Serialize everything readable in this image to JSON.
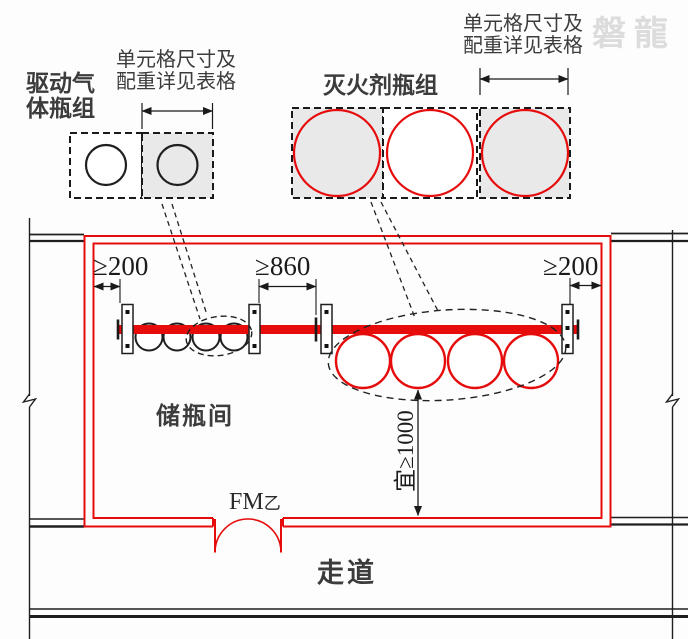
{
  "watermark": "磐龍",
  "colors": {
    "accent_red": "#e60c0c",
    "cell_fill_gray": "#e9e9e9",
    "line_black": "#1f1f1f",
    "watermark_gray": "#dcdcdd"
  },
  "callouts": {
    "driving_gas_group_label": "驱动气\n体瓶组",
    "driving_gas_note": "单元格尺寸及\n配重详见表格",
    "agent_group_label": "灭火剂瓶组",
    "agent_note": "单元格尺寸及\n配重详见表格"
  },
  "dimensions": {
    "left_wall_clearance": "≥200",
    "middle_clearance": "≥860",
    "right_wall_clearance": "≥200",
    "front_clearance": "宜≥1000"
  },
  "rooms": {
    "bottle_room": "储瓶间",
    "corridor": "走道"
  },
  "door": {
    "label": "FM",
    "suffix": "乙"
  }
}
